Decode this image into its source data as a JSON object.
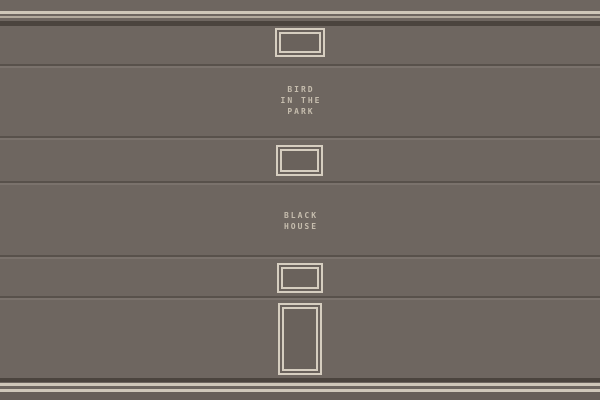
{
  "scene": {
    "signs": [
      {
        "id": "bird-in-the-park",
        "lines": [
          "BIRD",
          "IN THE",
          "PARK"
        ]
      },
      {
        "id": "black-house",
        "lines": [
          "BLACK",
          "HOUSE"
        ]
      }
    ],
    "windows": [
      {
        "name": "small-window-1"
      },
      {
        "name": "small-window-2"
      },
      {
        "name": "small-window-3"
      },
      {
        "name": "tall-door-window"
      }
    ],
    "colors": {
      "panel": "#6e6660",
      "panel-dark": "#665e58",
      "trim-light": "#cfc7b9",
      "trim-dim": "#b3aa9d",
      "groove-dark": "#4b443e",
      "seam-dark": "#58514b",
      "seam-light": "#7a726c",
      "frame": "#d6cec0",
      "pane": "#6a625c",
      "text": "#c6bdae"
    }
  }
}
